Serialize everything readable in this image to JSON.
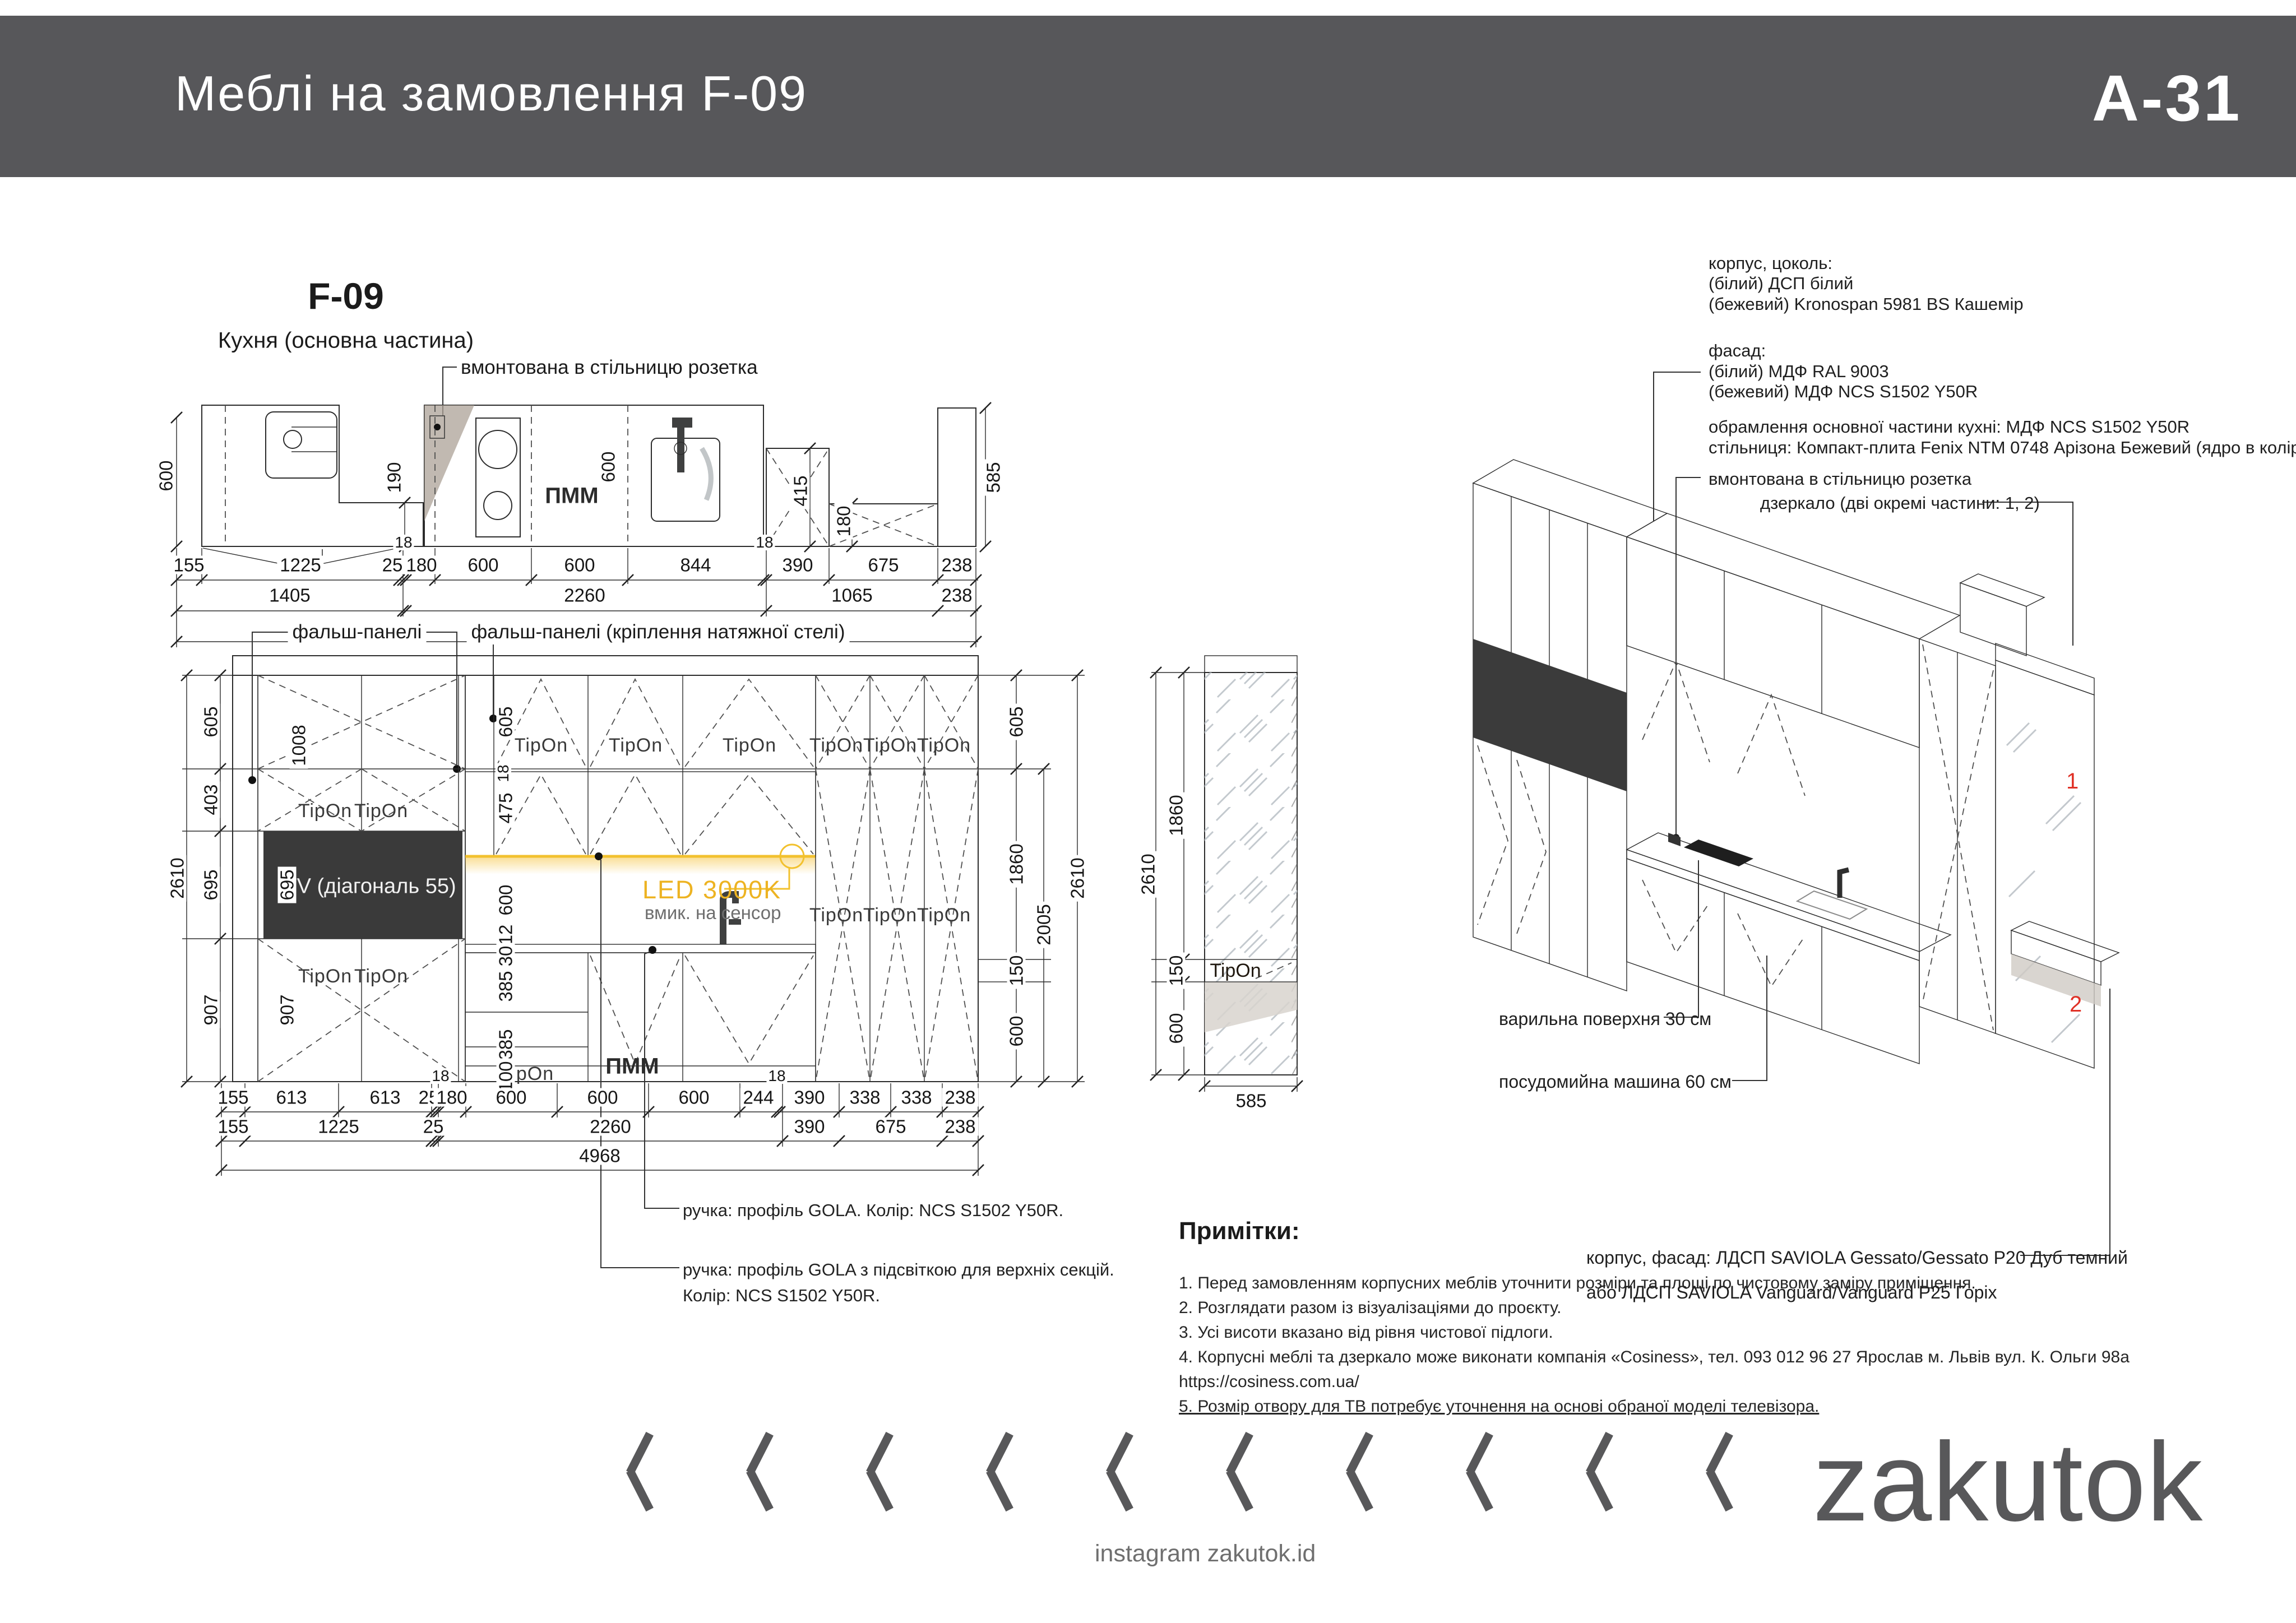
{
  "theme": {
    "header_bg": "#57575a",
    "accent_red": "#f02020",
    "beige": "#c9c1b7",
    "wood": "#5a4b3e",
    "led_yellow": "#f2c12e",
    "brand_gray": "#58585a"
  },
  "header": {
    "title": "Меблі на замовлення F-09",
    "sheet_code": "A-31"
  },
  "plan": {
    "title": "F-09",
    "subtitle": "Кухня (основна частина)",
    "socket_label": "вмонтована в стільницю розетка",
    "appliance_label": "ПММ",
    "dims": {
      "row1": [
        "155",
        "1225",
        "25",
        "180",
        "600",
        "600",
        "844",
        "390",
        "675",
        "238"
      ],
      "row1_raised": [
        "18",
        "18"
      ],
      "row2": [
        "1405",
        "2260",
        "1065",
        "238"
      ],
      "row3": [
        "4968"
      ],
      "vertical": [
        "600",
        "190",
        "600",
        "415",
        "180",
        "585"
      ]
    }
  },
  "elevation": {
    "false_panel_label": "фальш-панелі",
    "false_panel_ceiling_label": "фальш-панелі (кріплення натяжної стелі)",
    "tv_label": "TV (діагональ 55)",
    "led_label": "LED 3000K",
    "led_sensor_label": "вмик. на сенсор",
    "appliance_label": "ПММ",
    "door_system_label": "TipOn",
    "handle_note_1": "ручка: профіль GOLA. Колір: NCS S1502 Y50R.",
    "handle_note_2a": "ручка: профіль GOLA з підсвіткою для верхніх секцій.",
    "handle_note_2b": "Колір: NCS S1502 Y50R.",
    "dims": {
      "left_inner": [
        "605",
        "403",
        "695",
        "907"
      ],
      "left_outer": [
        "2610"
      ],
      "inner_boxed": [
        "1008",
        "695",
        "907"
      ],
      "mid": [
        "605",
        "475",
        "600",
        "12",
        "30",
        "385",
        "385",
        "100"
      ],
      "mid_small": [
        "18"
      ],
      "bottom_small": [
        "18"
      ],
      "right": [
        "605",
        "1860",
        "2005",
        "150",
        "600",
        "2610"
      ],
      "row1": [
        "155",
        "613",
        "613",
        "25",
        "180",
        "600",
        "600",
        "600",
        "244",
        "390",
        "338",
        "338",
        "238"
      ],
      "row1_raised": [
        "18",
        "18"
      ],
      "row2": [
        "155",
        "1225",
        "25",
        "2260",
        "390",
        "675",
        "238"
      ],
      "row3": [
        "4968"
      ]
    }
  },
  "mirror": {
    "shelf_label": "TipOn",
    "dims": {
      "left": [
        "1860",
        "150",
        "600"
      ],
      "outer": [
        "2610"
      ],
      "width": [
        "585"
      ]
    }
  },
  "specs": {
    "body_title": "корпус, цоколь:",
    "body_white": "(білий) ДСП білий",
    "body_beige": "(бежевий) Kronospan 5981   BS Кашемір",
    "facade_title": "фасад:",
    "facade_white": "(білий) МДФ RAL 9003",
    "facade_beige": "(бежевий) МДФ NCS S1502 Y50R",
    "frame_line": "обрамлення основної частини кухні: МДФ NCS S1502 Y50R",
    "worktop_line": "стільниця: Компакт-плита Fenix NTM 0748   Арізона Бежевий (ядро в колір)",
    "socket_line": "вмонтована в стільницю розетка",
    "mirror_line": "дзеркало (дві окремі частини: 1, 2)"
  },
  "iso": {
    "hob_label": "варильна поверхня 30 см",
    "dishwasher_label": "посудомийна машина 60 см",
    "material_line1": "корпус, фасад: ЛДСП SAVIOLA Gessato/Gessato   Р20 Дуб темний",
    "material_line2": "або ЛДСП SAVIOLA Vanguard/Vanguard Р25    Горіх",
    "marker_1": "1",
    "marker_2": "2"
  },
  "notes": {
    "heading": "Примітки:",
    "items": [
      "1. Перед замовленням корпусних меблів уточнити розміри та площі по чистовому заміру приміщення.",
      "2. Розглядати разом із візуалізаціями до проєкту.",
      "3. Усі висоти вказано від рівня чистової підлоги.",
      "4. Корпусні меблі та дзеркало може виконати компанія «Cosiness», тел. 093 012 96 27 Ярослав м. Львів вул. К. Ольги 98а https://cosiness.com.ua/",
      "5. Розмір отвору для ТВ потребує уточнення на основі обраної моделі телевізора."
    ]
  },
  "footer": {
    "brand": "zakutok",
    "instagram": "instagram zakutok.id",
    "chevron_count": 10
  }
}
